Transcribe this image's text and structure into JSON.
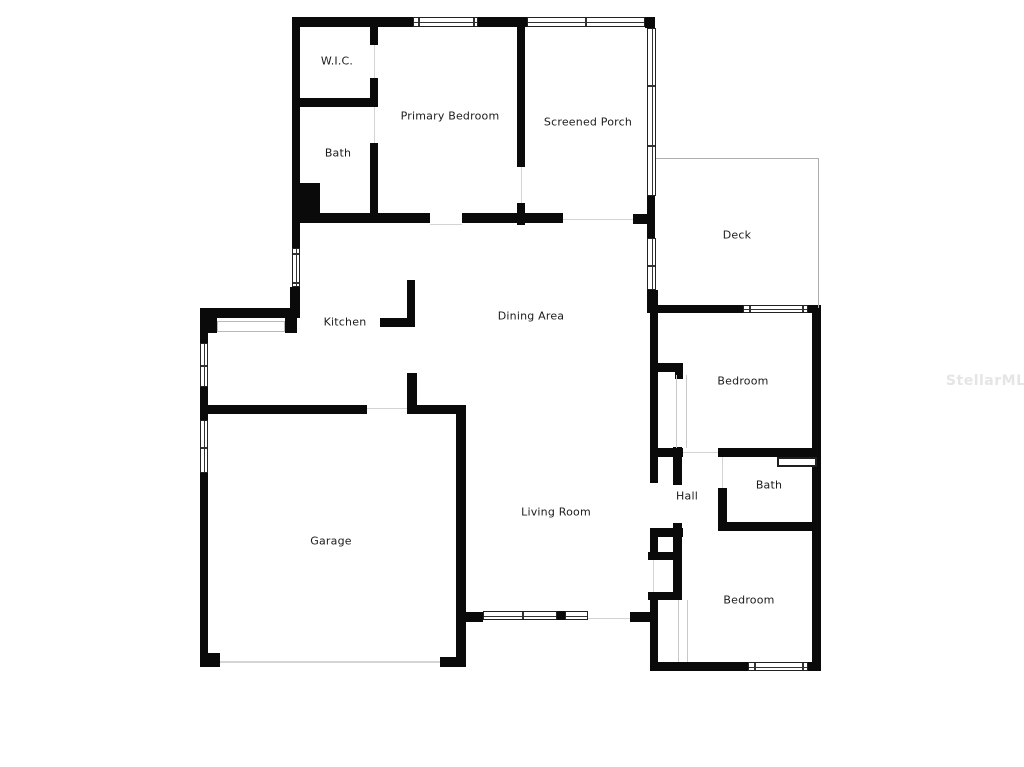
{
  "palette": {
    "background": "#ffffff",
    "wall_color": "#0a0a0a",
    "window_line_color": "#222222",
    "thin_line_color": "#c9c9c9",
    "deck_outline_color": "#aeaeae",
    "label_color": "#1b1b1b",
    "watermark_color": "#e5e5e5"
  },
  "rooms": [
    {
      "label": "W.I.C."
    },
    {
      "label": "Primary Bedroom"
    },
    {
      "label": "Screened Porch"
    },
    {
      "label": "Bath"
    },
    {
      "label": "Deck"
    },
    {
      "label": "Kitchen"
    },
    {
      "label": "Dining Area"
    },
    {
      "label": "Bedroom"
    },
    {
      "label": "Hall"
    },
    {
      "label": "Bath"
    },
    {
      "label": "Garage"
    },
    {
      "label": "Living Room"
    },
    {
      "label": "Bedroom"
    }
  ],
  "watermark": {
    "text": "StellarMLS"
  }
}
